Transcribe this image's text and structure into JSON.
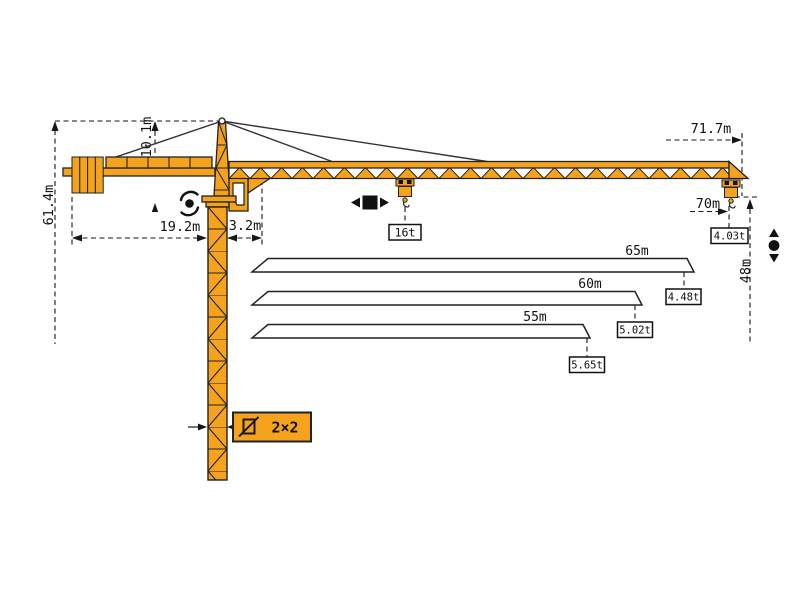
{
  "diagram": {
    "type": "tower-crane-specification-drawing",
    "colors": {
      "crane_orange": "#F5A31D",
      "outline": "#222222",
      "dimension_lines": "#161616",
      "background": "#ffffff"
    },
    "dimensions": {
      "total_height": "61.4m",
      "tower_head_height": "10.1m",
      "counter_jib_length": "19.2m",
      "jib_heel_offset": "3.2m",
      "max_working_radius": "71.7m",
      "tip_load_radius": "70m",
      "tip_hook_height": "48m"
    },
    "mast": {
      "section_size": "2×2"
    },
    "loads": {
      "max_lifting_load": "16t",
      "tip_load_at_70m": "4.03t"
    },
    "jib_variants": [
      {
        "length": "65m",
        "tip_load": "4.48t"
      },
      {
        "length": "60m",
        "tip_load": "5.02t"
      },
      {
        "length": "55m",
        "tip_load": "5.65t"
      }
    ],
    "icons": [
      "slewing-icon",
      "trolley-travel-icon",
      "hoisting-icon",
      "mast-section-icon"
    ]
  }
}
